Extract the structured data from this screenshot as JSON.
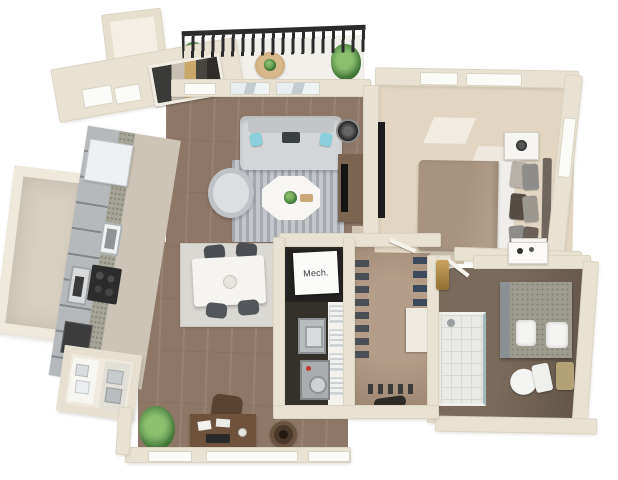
{
  "floorplan": {
    "style": "3d-rendered-apartment-floor-plan",
    "mech_label": "Mech.",
    "rooms": [
      "balcony",
      "living-room",
      "dining-area",
      "kitchen",
      "bedroom",
      "bathroom",
      "walk-in-closet",
      "laundry-closet",
      "mech-closet",
      "storage-room",
      "entry-hall",
      "desk-nook",
      "hallway",
      "entry-closet"
    ],
    "objects": [
      "balcony-railing",
      "patio-table",
      "potted-plants",
      "wall-art",
      "sofa",
      "accent-pillows",
      "armchair",
      "coffee-table",
      "area-rug",
      "floor-lamp",
      "tv-console",
      "dining-table",
      "dining-chairs",
      "refrigerator",
      "kitchen-sink",
      "stove",
      "oven",
      "bed",
      "nightstands",
      "table-lamps",
      "dresser-tv",
      "washer",
      "dryer",
      "linen-shelves",
      "hanging-clothes",
      "shoes",
      "double-vanity",
      "sinks",
      "toilet",
      "shower",
      "desk",
      "desk-chair",
      "ottoman",
      "house-plant",
      "gold-mirror",
      "makeup-desk"
    ],
    "colors": {
      "background": "#ffffff",
      "wall": "#e9e2d2",
      "wood_floor": "#8e7767",
      "bedroom_carpet": "#e2d6c3",
      "closet_floor": "#a8917c",
      "bathroom_floor": "#6e5f51",
      "laundry_floor": "#34302a",
      "mech_floor": "#242220",
      "balcony_floor": "#f2f0ea",
      "railing": "#2b2b2b",
      "sofa": "#d3d6d8",
      "accent_pillow": "#8ccfdc",
      "rug": "#c3c7cc",
      "dining_table": "#f5f4f1",
      "desk_wood": "#6f523c",
      "bed_blanket": "#a7937f",
      "cabinet_gray": "#b5b9bc",
      "granite": "#9d9c8e",
      "plant_green": "#5f9350",
      "gold_accent": "#b08d4f"
    }
  }
}
